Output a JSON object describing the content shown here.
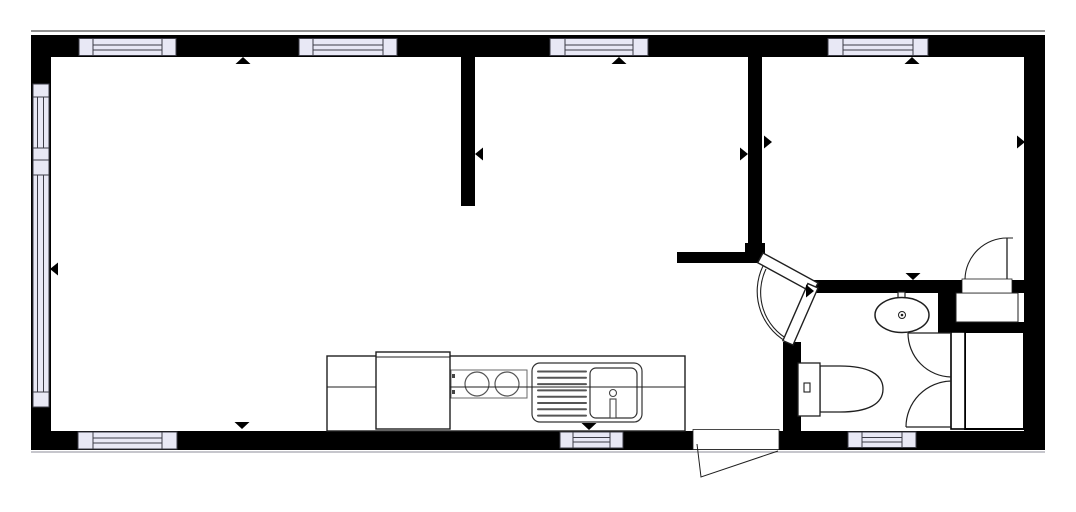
{
  "canvas": {
    "width": 1076,
    "height": 512,
    "background": "#ffffff"
  },
  "colors": {
    "wall": "#000000",
    "window_fill": "#e8e8f5",
    "window_stroke": "#3c3c46",
    "line": "#1f1f1f",
    "light": "#5a5a60",
    "shadow": "#a5a5ad"
  },
  "plan": {
    "walls": [
      {
        "name": "outer-wall-top",
        "x": 31,
        "y": 35,
        "w": 1014,
        "h": 22
      },
      {
        "name": "outer-wall-bottom",
        "x": 31,
        "y": 431,
        "w": 1014,
        "h": 19
      },
      {
        "name": "outer-wall-left",
        "x": 31,
        "y": 35,
        "w": 20,
        "h": 415
      },
      {
        "name": "outer-wall-right",
        "x": 1024,
        "y": 35,
        "w": 21,
        "h": 415
      },
      {
        "name": "partition-living-middle",
        "x": 461,
        "y": 57,
        "w": 14,
        "h": 149
      },
      {
        "name": "partition-middle-bedroom",
        "x": 748,
        "y": 57,
        "w": 14,
        "h": 195
      },
      {
        "name": "hall-corner-block",
        "x": 745,
        "y": 243,
        "w": 20,
        "h": 20
      },
      {
        "name": "hall-stub-wall",
        "x": 677,
        "y": 252,
        "w": 88,
        "h": 11
      },
      {
        "name": "bathroom-top-wall",
        "x": 810,
        "y": 280,
        "w": 131,
        "h": 13
      },
      {
        "name": "bedroom-bottom-wall",
        "x": 941,
        "y": 280,
        "w": 83,
        "h": 13
      },
      {
        "name": "nook-vertical-wall",
        "x": 938,
        "y": 280,
        "w": 18,
        "h": 53
      },
      {
        "name": "niche-bottom-wall",
        "x": 938,
        "y": 322,
        "w": 88,
        "h": 11
      },
      {
        "name": "bathroom-left-wall",
        "x": 783,
        "y": 342,
        "w": 18,
        "h": 89
      }
    ],
    "face_lines": [
      {
        "name": "outer-face-top",
        "x1": 31,
        "y1": 31,
        "x2": 1045,
        "y2": 31
      },
      {
        "name": "outer-face-bottom",
        "x1": 31,
        "y1": 452,
        "x2": 1045,
        "y2": 452
      }
    ],
    "windows": [
      {
        "name": "window-top-living-1",
        "x": 79,
        "y": 38.5,
        "w": 97,
        "h": 17,
        "cap": 14,
        "lines": [
          45,
          50
        ]
      },
      {
        "name": "window-top-living-2",
        "x": 299,
        "y": 38.5,
        "w": 98,
        "h": 17,
        "cap": 14,
        "lines": [
          45,
          50
        ]
      },
      {
        "name": "window-top-middle",
        "x": 550,
        "y": 38.5,
        "w": 98,
        "h": 17,
        "cap": 15,
        "lines": [
          45,
          50
        ]
      },
      {
        "name": "window-top-bedroom",
        "x": 828,
        "y": 38.5,
        "w": 100,
        "h": 17,
        "cap": 15,
        "lines": [
          45,
          50
        ]
      },
      {
        "name": "window-bottom-living",
        "x": 78,
        "y": 432,
        "w": 99,
        "h": 17,
        "cap": 15,
        "lines": [
          438,
          443
        ]
      },
      {
        "name": "window-kitchen",
        "x": 560,
        "y": 432,
        "w": 63,
        "h": 16,
        "cap": 13,
        "lines": [
          437.5,
          442
        ]
      },
      {
        "name": "window-bathroom",
        "x": 848,
        "y": 432,
        "w": 68,
        "h": 15.5,
        "cap": 14,
        "lines": [
          437.5,
          442
        ]
      }
    ],
    "left_window": {
      "name": "window-left-assembly",
      "x": 33,
      "w": 16,
      "pane_lines": [
        37.5,
        43.5
      ],
      "segments": [
        {
          "kind": "sill",
          "y": 84,
          "h": 13
        },
        {
          "kind": "pane",
          "y": 97,
          "h": 51
        },
        {
          "kind": "sill",
          "y": 148,
          "h": 12
        },
        {
          "kind": "sill",
          "y": 160,
          "h": 15
        },
        {
          "kind": "pane",
          "y": 175,
          "h": 217
        },
        {
          "kind": "sill",
          "y": 392,
          "h": 15
        }
      ]
    },
    "doors": {
      "entry": {
        "opening": {
          "x": 693,
          "y": 429.5,
          "w": 86,
          "h": 20
        },
        "swing_path": "M697,444 L701,477 L778,451"
      },
      "bedroom": {
        "opening": {
          "x": 962,
          "y": 279,
          "w": 50,
          "h": 14
        },
        "leaf": {
          "x1": 1007,
          "y1": 238,
          "x2": 1007,
          "y2": 279
        },
        "leaf_tick": {
          "x1": 1007,
          "y1": 238,
          "x2": 1013,
          "y2": 238
        },
        "arc_path": "M965,279 A42,42 0 0 1 1007,238"
      },
      "bathroom_bifold": {
        "leaf1_points": "763,253 818,283 812.7,292.7 757.7,262.7",
        "leaf2_points": "818,288 793,345 782.9,340.6 807.9,283.6",
        "arc_paths": [
          "M763,266 A58,58 0 0 0 791,344",
          "M766,269 A54,54 0 0 0 789,340"
        ]
      },
      "shower_doors": {
        "leaf_lines": [
          {
            "x1": 908,
            "y1": 333,
            "x2": 951,
            "y2": 333
          },
          {
            "x1": 906,
            "y1": 427,
            "x2": 951,
            "y2": 427
          }
        ],
        "arc_paths": [
          "M908,333 A44,44 0 0 0 951,377",
          "M906,427 A46,46 0 0 1 951,381"
        ]
      }
    },
    "fixtures": {
      "kitchen_counter": {
        "x": 327,
        "y": 356,
        "w": 358,
        "h": 75
      },
      "counter_line": {
        "x1": 327,
        "y1": 387,
        "x2": 685,
        "y2": 387
      },
      "refrigerator": {
        "x": 376,
        "y": 352,
        "w": 74,
        "h": 77,
        "accent_y": 357
      },
      "stove": {
        "x": 451,
        "y": 370,
        "w": 76,
        "h": 28,
        "burners": [
          [
            477,
            384,
            12
          ],
          [
            507,
            384,
            12
          ]
        ],
        "knobs": [
          [
            452,
            374
          ],
          [
            452,
            390
          ]
        ]
      },
      "kitchen_sink": {
        "unit": {
          "x": 532,
          "y": 363,
          "w": 110,
          "h": 59,
          "r": 8
        },
        "basin": {
          "x": 590,
          "y": 368,
          "w": 47,
          "h": 50,
          "r": 6
        },
        "drain_lines": {
          "x1": 538,
          "x2": 586,
          "y0": 371.5,
          "step": 6.3,
          "count": 8
        },
        "faucet": {
          "cx": 613,
          "cy": 393,
          "r": 3.5,
          "bar": {
            "x": 610,
            "y": 399,
            "w": 6,
            "h": 19
          }
        }
      },
      "washbasin": {
        "cx": 902,
        "cy": 315,
        "rx": 27,
        "ry": 17.5,
        "tap": {
          "x": 898,
          "y": 292,
          "w": 7,
          "h": 13
        },
        "drain_r": 3.5,
        "drain_dot_r": 1.3
      },
      "toilet": {
        "tank": {
          "x": 798,
          "y": 363,
          "w": 22,
          "h": 53
        },
        "button": {
          "x": 804,
          "y": 383,
          "w": 6,
          "h": 9
        },
        "bowl_path": "M820,366 L840,366 C868,366 883,374 883,389 C883,404 868,412 840,412 L820,412 Z"
      },
      "shower_panel": {
        "x": 951,
        "y": 332,
        "w": 14,
        "h": 97
      },
      "shower_box": {
        "x": 965,
        "y": 332,
        "w": 59,
        "h": 97
      },
      "hall_niche": {
        "x": 956,
        "y": 293,
        "w": 62,
        "h": 29
      }
    },
    "markers": [
      {
        "name": "marker-north-living",
        "dir": "up",
        "ax": 243,
        "ay": 57
      },
      {
        "name": "marker-north-middle",
        "dir": "up",
        "ax": 619,
        "ay": 57
      },
      {
        "name": "marker-north-bedroom",
        "dir": "up",
        "ax": 912,
        "ay": 57
      },
      {
        "name": "marker-south-living",
        "dir": "down",
        "ax": 242,
        "ay": 429
      },
      {
        "name": "marker-south-kitchen",
        "dir": "down",
        "ax": 589,
        "ay": 430
      },
      {
        "name": "marker-south-bedroom",
        "dir": "down",
        "ax": 913,
        "ay": 280
      },
      {
        "name": "marker-west-wall1",
        "dir": "left",
        "ax": 475,
        "ay": 154
      },
      {
        "name": "marker-west-outer",
        "dir": "left",
        "ax": 50,
        "ay": 269
      },
      {
        "name": "marker-east-wall2-a",
        "dir": "right",
        "ax": 748,
        "ay": 154
      },
      {
        "name": "marker-east-wall2-b",
        "dir": "right",
        "ax": 772,
        "ay": 142
      },
      {
        "name": "marker-east-outer",
        "dir": "right",
        "ax": 1025,
        "ay": 142
      },
      {
        "name": "marker-bifold-hinge",
        "dir": "right",
        "ax": 814,
        "ay": 291
      }
    ]
  }
}
